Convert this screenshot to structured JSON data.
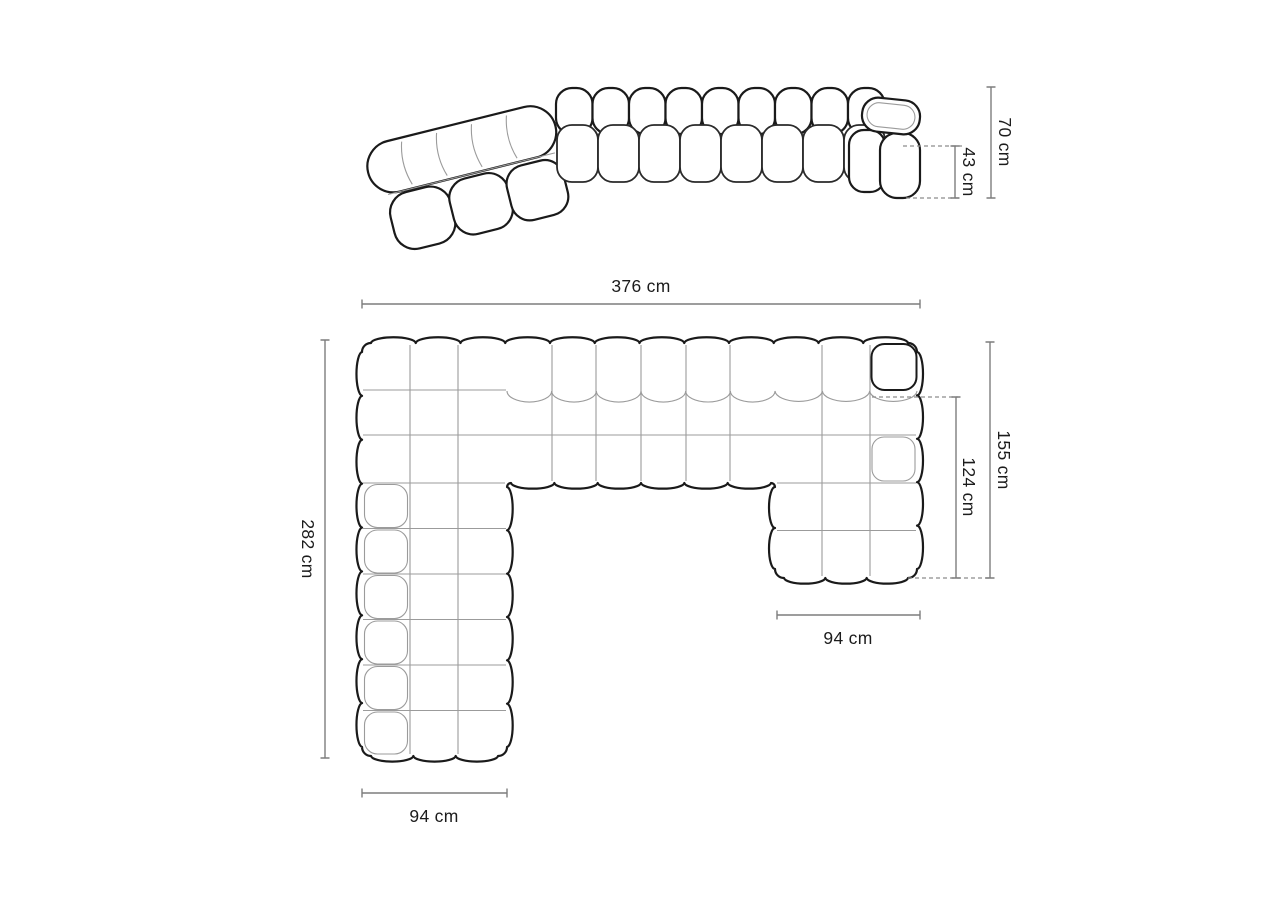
{
  "page": {
    "background": "#ffffff"
  },
  "views": {
    "perspective": {
      "name": "sofa-front-perspective-view"
    },
    "plan": {
      "name": "sofa-top-plan-view"
    }
  },
  "dimensions": {
    "total_height": {
      "label": "70 cm"
    },
    "seat_height": {
      "label": "43 cm"
    },
    "total_width": {
      "label": "376 cm"
    },
    "total_depth": {
      "label": "282 cm"
    },
    "right_side_depth": {
      "label": "155 cm"
    },
    "right_chaise_depth": {
      "label": "124 cm"
    },
    "right_chaise_width": {
      "label": "94 cm"
    },
    "left_chaise_width": {
      "label": "94 cm"
    }
  },
  "colors": {
    "outline": "#1a1a1a",
    "inner_line": "#9b9b9b",
    "dimension_line": "#7d7d7d",
    "dashed_guide": "#8c8c8c",
    "text": "#1c1c1c",
    "background": "#ffffff"
  }
}
